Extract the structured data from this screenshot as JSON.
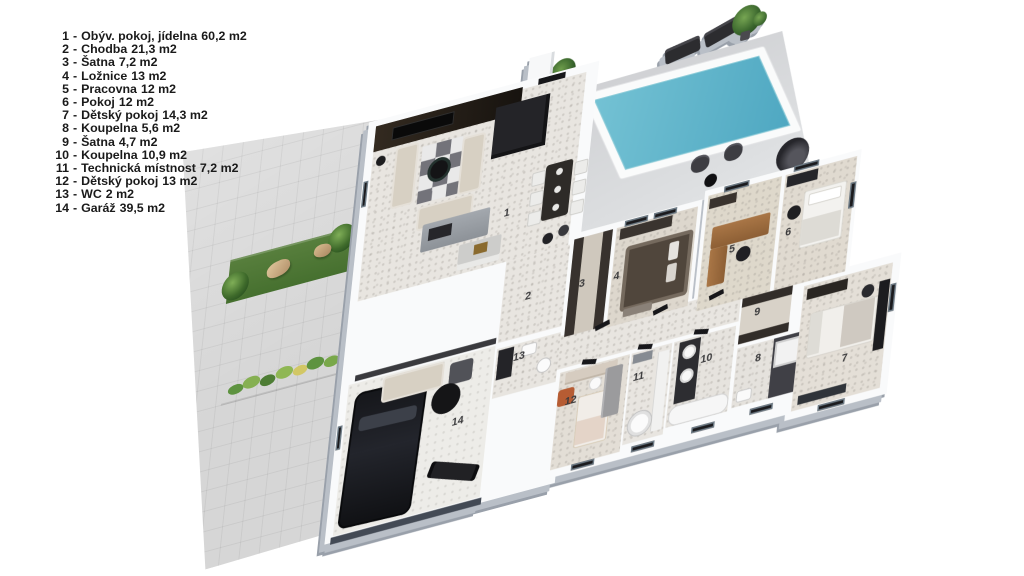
{
  "legend": {
    "separator": "-",
    "items": [
      {
        "num": "1",
        "name": "Obýv. pokoj, jídelna",
        "area": "60,2 m2"
      },
      {
        "num": "2",
        "name": "Chodba",
        "area": "21,3 m2"
      },
      {
        "num": "3",
        "name": "Šatna",
        "area": "7,2 m2"
      },
      {
        "num": "4",
        "name": "Ložnice",
        "area": "13 m2"
      },
      {
        "num": "5",
        "name": "Pracovna",
        "area": "12 m2"
      },
      {
        "num": "6",
        "name": "Pokoj",
        "area": "12 m2"
      },
      {
        "num": "7",
        "name": "Dětský pokoj",
        "area": "14,3 m2"
      },
      {
        "num": "8",
        "name": "Koupelna",
        "area": "5,6 m2"
      },
      {
        "num": "9",
        "name": "Šatna",
        "area": "4,7 m2"
      },
      {
        "num": "10",
        "name": "Koupelna",
        "area": "10,9 m2"
      },
      {
        "num": "11",
        "name": "Technická místnost",
        "area": "7,2 m2"
      },
      {
        "num": "12",
        "name": "Dětský pokoj",
        "area": "13 m2"
      },
      {
        "num": "13",
        "name": "WC",
        "area": "2 m2"
      },
      {
        "num": "14",
        "name": "Garáž",
        "area": "39,5 m2"
      }
    ]
  },
  "floor_labels": [
    "1",
    "2",
    "3",
    "4",
    "5",
    "6",
    "7",
    "8",
    "9",
    "10",
    "11",
    "12",
    "13",
    "14"
  ],
  "colors": {
    "pool_water": "#5cb1c7",
    "deck": "#d4d5d7",
    "walls": "#f9fafb",
    "floor_tile": "#e8e5e0",
    "grass": "#4e7a37",
    "wood_desk": "#9c6b3f",
    "sofa_beige": "#d7d0c3",
    "accent_dark": "#242428",
    "shadow_side": "#9aa1ab"
  }
}
